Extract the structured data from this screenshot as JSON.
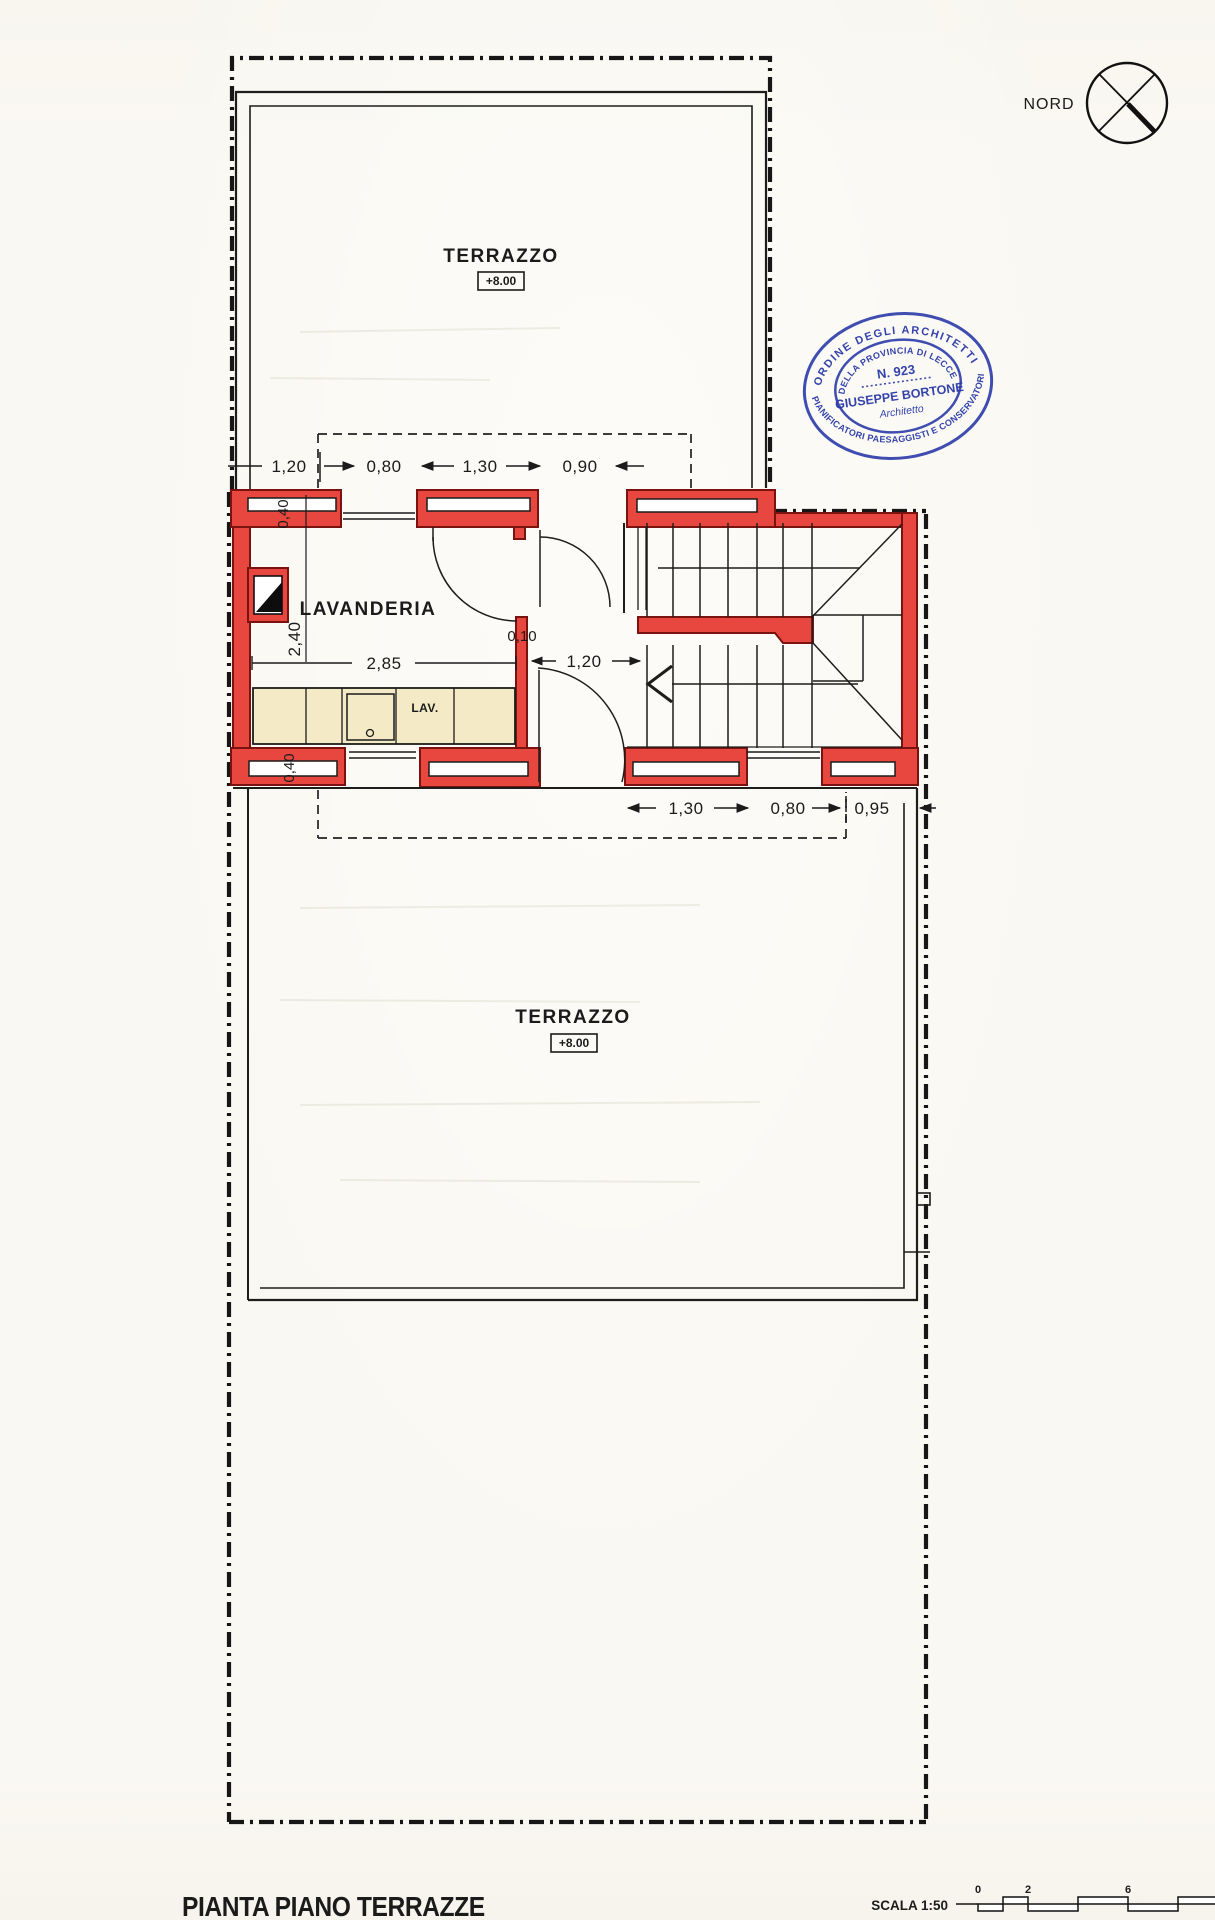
{
  "drawing": {
    "title": "PIANTA PIANO TERRAZZE",
    "scale_label": "SCALA 1:50",
    "scale_ticks": [
      "0",
      "2",
      "6"
    ],
    "north_label": "NORD",
    "rooms": {
      "terrace_upper": {
        "name": "TERRAZZO",
        "elevation": "+8.00"
      },
      "terrace_lower": {
        "name": "TERRAZZO",
        "elevation": "+8.00"
      },
      "laundry": {
        "name": "LAVANDERIA"
      },
      "appliance": "LAV."
    },
    "dimensions": {
      "top": [
        "1,20",
        "0,80",
        "1,30",
        "0,90"
      ],
      "left": [
        "0,40",
        "2,40",
        "0,40"
      ],
      "inner": [
        "2,85",
        "0,10",
        "1,20"
      ],
      "bottom": [
        "1,30",
        "0,80",
        "0,95"
      ]
    },
    "stamp": {
      "outer_top": "ORDINE DEGLI ARCHITETTI",
      "outer_bottom": "PIANIFICATORI PAESAGGISTI E CONSERVATORI",
      "inner_top": "DELLA PROVINCIA DI LECCE",
      "reg_number": "N. 923",
      "name": "GIUSEPPE BORTONE",
      "role": "Architetto"
    },
    "colors": {
      "wall_red": "#e8473f",
      "wall_border": "#7a1210",
      "stamp_blue": "#2a3aa8",
      "counter_beige": "#f4ebc6",
      "line_black": "#1d1d1b",
      "paper": "#faf8f2"
    }
  }
}
